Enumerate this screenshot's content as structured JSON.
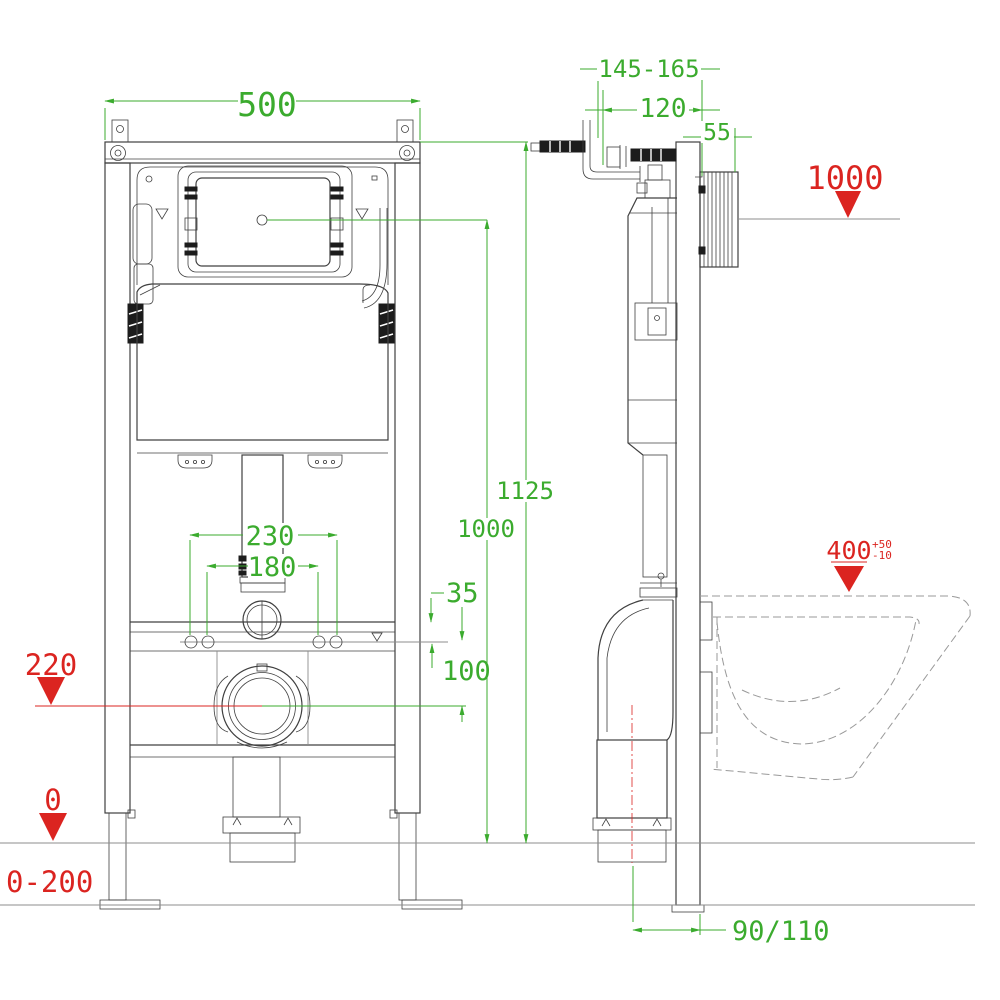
{
  "drawing_title": "Concealed cistern wall-hung toilet frame installation drawing",
  "colors": {
    "dimension_green": "#3BAB2E",
    "level_red": "#DB2420",
    "line_dark": "#404040",
    "line_light": "#8C8C8C"
  },
  "front_view": {
    "frame_width": "500",
    "fixing_span_outer": "230",
    "fixing_span_inner": "180",
    "pipe_to_holes_offset": "35",
    "holes_to_drain_offset": "100",
    "frame_top_height": "1125",
    "panel_centre_height": "1000",
    "drain_centre_level": "220",
    "floor_level": "0",
    "floor_adjust_range": "0-200"
  },
  "side_view": {
    "wall_offset_range": "145-165",
    "frame_depth": "120",
    "plate_housing_depth": "55",
    "water_supply_height": "1000",
    "bowl_rim_height": "400",
    "bowl_rim_tol_plus": "+50",
    "bowl_rim_tol_minus": "-10",
    "drain_wall_offset": "90/110"
  }
}
